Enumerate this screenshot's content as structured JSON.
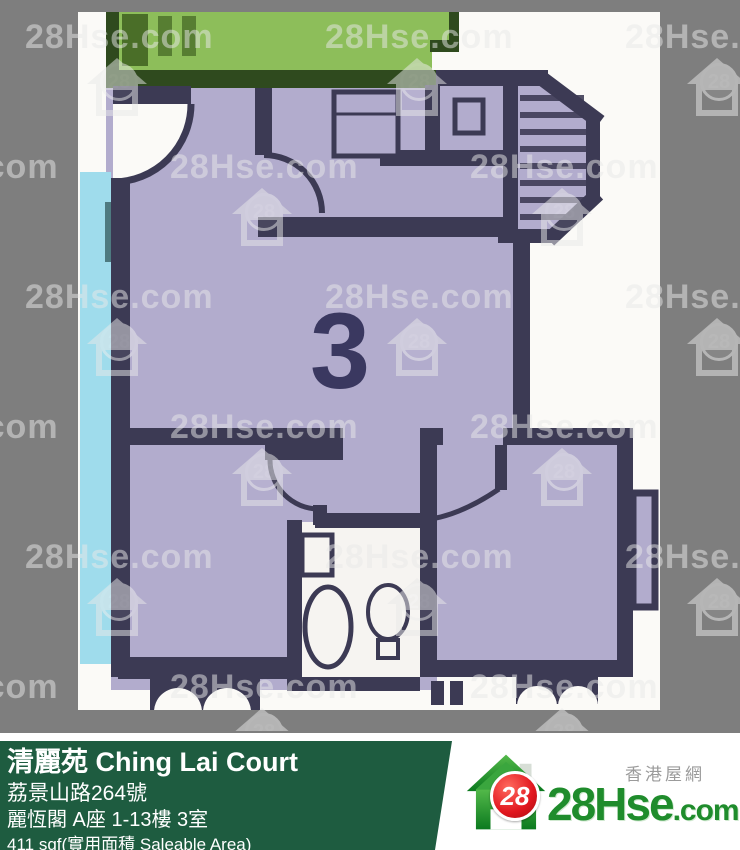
{
  "floorplan": {
    "unit_label": "3",
    "colors": {
      "background_gray": "#7e7e7e",
      "scan_white": "#fbfaf7",
      "floor_purple": "#b2accd",
      "wall_navy": "#3c3a54",
      "neighbor_green": "#8dbe5a",
      "neighbor_green_dark": "#2f4a1e",
      "pipe_cyan": "#9fdcec",
      "pipe_teal": "#4e7a80"
    }
  },
  "watermark": {
    "text": "28Hse.com",
    "icon_number": "28"
  },
  "banner": {
    "title": "清麗苑 Ching Lai Court",
    "address": "荔景山路264號",
    "block_info": "麗恆閣 A座 1-13樓 3室",
    "area_info": "411 sqf(實用面積 Saleable Area)",
    "bg_color": "#1e5c40"
  },
  "logo": {
    "tagline": "香港屋網",
    "badge_number": "28",
    "brand_main": "28Hse",
    "brand_suffix": ".com"
  }
}
